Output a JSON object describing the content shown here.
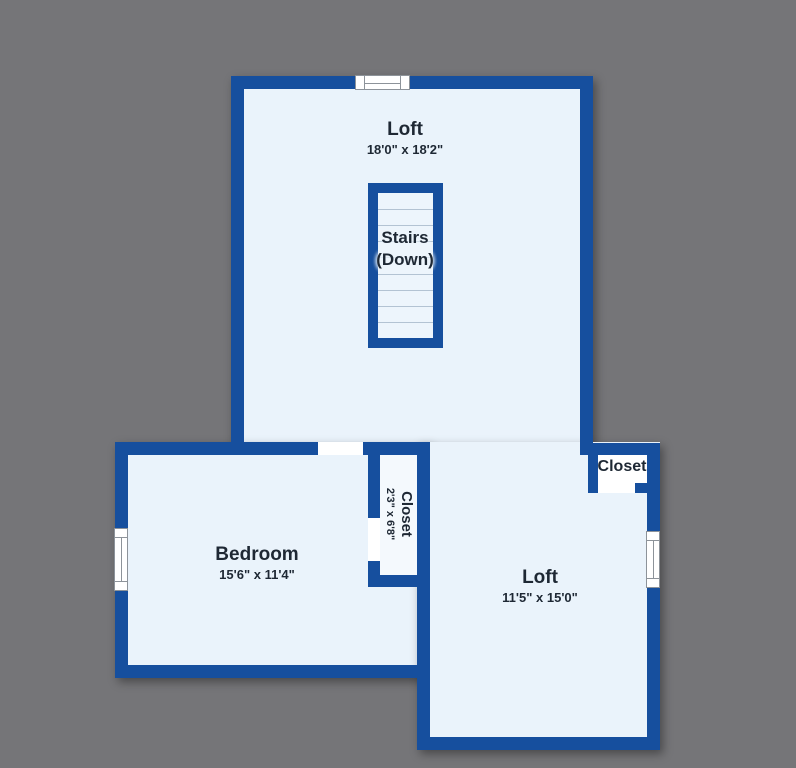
{
  "rooms": {
    "top_loft": {
      "name": "Loft",
      "dims": "18'0\" x 18'2\""
    },
    "stairs": {
      "line1": "Stairs",
      "line2": "(Down)"
    },
    "bedroom": {
      "name": "Bedroom",
      "dims": "15'6\" x 11'4\""
    },
    "bedroom_closet": {
      "name": "Closet",
      "dims": "2'3\" x 6'8\""
    },
    "right_loft": {
      "name": "Loft",
      "dims": "11'5\" x 15'0\""
    },
    "corner_closet": {
      "name": "Closet"
    }
  },
  "colors": {
    "background": "#757578",
    "wall": "#164f9e",
    "room_fill": "#eaf3fb",
    "closet_fill": "#f4f9fd",
    "stair_line": "#b3c3d3",
    "window_fill": "#ffffff",
    "text": "#1e2834"
  }
}
